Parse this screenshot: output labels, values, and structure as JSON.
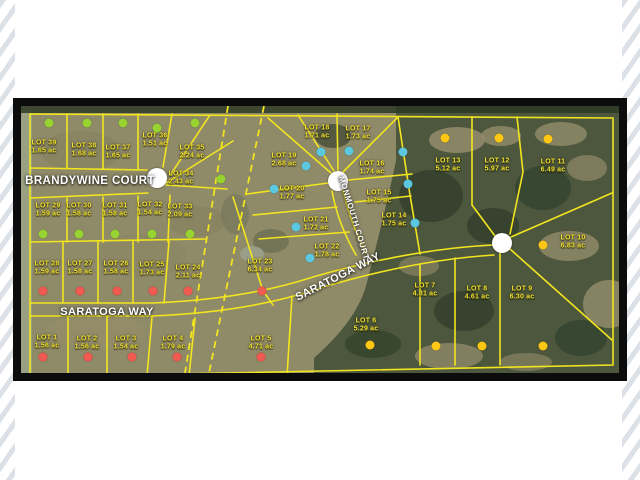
{
  "map": {
    "title": "aerial plat map of subdivision lots",
    "roads": [
      {
        "id": "brandywine-court",
        "label": "BRANDYWINE COURT"
      },
      {
        "id": "saratoga-way-west",
        "label": "SARATOGA WAY"
      },
      {
        "id": "saratoga-way-curve",
        "label": "SARATOGA WAY"
      },
      {
        "id": "monmouth-court",
        "label": "MONMOUTH COURT"
      }
    ],
    "status_colors": {
      "green": "#97d431",
      "red": "#f05a50",
      "cyan": "#5cc8e0",
      "yellow": "#ffc613"
    },
    "cul_de_sacs": [
      {
        "id": "brandywine-circle",
        "x": 136,
        "y": 72
      },
      {
        "id": "monmouth-circle",
        "x": 317,
        "y": 75
      },
      {
        "id": "east-circle",
        "x": 481,
        "y": 137
      }
    ],
    "lots": [
      {
        "name": "LOT 1",
        "area": "1.56 ac",
        "color": "red",
        "lx": 26,
        "ly": 236,
        "dx": 22,
        "dy": 251
      },
      {
        "name": "LOT 2",
        "area": "1.56 ac",
        "color": "red",
        "lx": 66,
        "ly": 237,
        "dx": 67,
        "dy": 251
      },
      {
        "name": "LOT 3",
        "area": "1.54 ac",
        "color": "red",
        "lx": 105,
        "ly": 237,
        "dx": 111,
        "dy": 251
      },
      {
        "name": "LOT 4",
        "area": "1.79 ac",
        "color": "red",
        "lx": 152,
        "ly": 237,
        "dx": 156,
        "dy": 251
      },
      {
        "name": "LOT 5",
        "area": "4.71 ac",
        "color": "red",
        "lx": 240,
        "ly": 237,
        "dx": 240,
        "dy": 251
      },
      {
        "name": "LOT 6",
        "area": "5.29 ac",
        "color": "yellow",
        "lx": 345,
        "ly": 219,
        "dx": 349,
        "dy": 239
      },
      {
        "name": "LOT 7",
        "area": "4.81 ac",
        "color": "yellow",
        "lx": 404,
        "ly": 184,
        "dx": 415,
        "dy": 240
      },
      {
        "name": "LOT 8",
        "area": "4.61 ac",
        "color": "yellow",
        "lx": 456,
        "ly": 187,
        "dx": 461,
        "dy": 240
      },
      {
        "name": "LOT 9",
        "area": "6.30 ac",
        "color": "yellow",
        "lx": 501,
        "ly": 187,
        "dx": 522,
        "dy": 240
      },
      {
        "name": "LOT 10",
        "area": "6.83 ac",
        "color": "yellow",
        "lx": 552,
        "ly": 136,
        "dx": 522,
        "dy": 139
      },
      {
        "name": "LOT 11",
        "area": "6.49 ac",
        "color": "yellow",
        "lx": 532,
        "ly": 60,
        "dx": 527,
        "dy": 33
      },
      {
        "name": "LOT 12",
        "area": "5.97 ac",
        "color": "yellow",
        "lx": 476,
        "ly": 59,
        "dx": 478,
        "dy": 32
      },
      {
        "name": "LOT 13",
        "area": "5.12 ac",
        "color": "yellow",
        "lx": 427,
        "ly": 59,
        "dx": 424,
        "dy": 32
      },
      {
        "name": "LOT 14",
        "area": "1.75 ac",
        "color": "cyan",
        "lx": 373,
        "ly": 114,
        "dx": 394,
        "dy": 117
      },
      {
        "name": "LOT 15",
        "area": "1.75 ac",
        "color": "cyan",
        "lx": 358,
        "ly": 91,
        "dx": 387,
        "dy": 78
      },
      {
        "name": "LOT 16",
        "area": "1.74 ac",
        "color": "cyan",
        "lx": 351,
        "ly": 62,
        "dx": 382,
        "dy": 46
      },
      {
        "name": "LOT 17",
        "area": "1.73 ac",
        "color": "cyan",
        "lx": 337,
        "ly": 27,
        "dx": 328,
        "dy": 45
      },
      {
        "name": "LOT 18",
        "area": "1.71 ac",
        "color": "cyan",
        "lx": 296,
        "ly": 26,
        "dx": 300,
        "dy": 46
      },
      {
        "name": "LOT 19",
        "area": "2.68 ac",
        "color": "cyan",
        "lx": 263,
        "ly": 54,
        "dx": 285,
        "dy": 60
      },
      {
        "name": "LOT 20",
        "area": "1.77 ac",
        "color": "cyan",
        "lx": 271,
        "ly": 87,
        "dx": 253,
        "dy": 83
      },
      {
        "name": "LOT 21",
        "area": "1.72 ac",
        "color": "cyan",
        "lx": 295,
        "ly": 118,
        "dx": 275,
        "dy": 121
      },
      {
        "name": "LOT 22",
        "area": "1.78 ac",
        "color": "cyan",
        "lx": 306,
        "ly": 145,
        "dx": 289,
        "dy": 152
      },
      {
        "name": "LOT 23",
        "area": "6.34 ac",
        "color": "red",
        "lx": 239,
        "ly": 160,
        "dx": 241,
        "dy": 185
      },
      {
        "name": "LOT 24",
        "area": "2.11 ac",
        "color": "red",
        "lx": 167,
        "ly": 166,
        "dx": 167,
        "dy": 185
      },
      {
        "name": "LOT 25",
        "area": "1.73 ac",
        "color": "red",
        "lx": 131,
        "ly": 163,
        "dx": 132,
        "dy": 185
      },
      {
        "name": "LOT 26",
        "area": "1.58 ac",
        "color": "red",
        "lx": 95,
        "ly": 162,
        "dx": 96,
        "dy": 185
      },
      {
        "name": "LOT 27",
        "area": "1.58 ac",
        "color": "red",
        "lx": 59,
        "ly": 162,
        "dx": 59,
        "dy": 185
      },
      {
        "name": "LOT 28",
        "area": "1.59 ac",
        "color": "red",
        "lx": 26,
        "ly": 162,
        "dx": 22,
        "dy": 185
      },
      {
        "name": "LOT 29",
        "area": "1.59 ac",
        "color": "green",
        "lx": 27,
        "ly": 104,
        "dx": 22,
        "dy": 128
      },
      {
        "name": "LOT 30",
        "area": "1.58 ac",
        "color": "green",
        "lx": 58,
        "ly": 104,
        "dx": 58,
        "dy": 128
      },
      {
        "name": "LOT 31",
        "area": "1.58 ac",
        "color": "green",
        "lx": 94,
        "ly": 104,
        "dx": 94,
        "dy": 128
      },
      {
        "name": "LOT 32",
        "area": "1.54 ac",
        "color": "green",
        "lx": 129,
        "ly": 103,
        "dx": 131,
        "dy": 128
      },
      {
        "name": "LOT 33",
        "area": "2.09 ac",
        "color": "green",
        "lx": 159,
        "ly": 105,
        "dx": 169,
        "dy": 128
      },
      {
        "name": "LOT 34",
        "area": "2.43 ac",
        "color": "green",
        "lx": 160,
        "ly": 72,
        "dx": 200,
        "dy": 73
      },
      {
        "name": "LOT 35",
        "area": "2.24 ac",
        "color": "green",
        "lx": 171,
        "ly": 46,
        "dx": 174,
        "dy": 17
      },
      {
        "name": "LOT 36",
        "area": "1.51 ac",
        "color": "green",
        "lx": 134,
        "ly": 34,
        "dx": 136,
        "dy": 22
      },
      {
        "name": "LOT 37",
        "area": "1.65 ac",
        "color": "green",
        "lx": 97,
        "ly": 46,
        "dx": 102,
        "dy": 17
      },
      {
        "name": "LOT 38",
        "area": "1.68 ac",
        "color": "green",
        "lx": 63,
        "ly": 44,
        "dx": 66,
        "dy": 17
      },
      {
        "name": "LOT 39",
        "area": "1.65 ac",
        "color": "green",
        "lx": 23,
        "ly": 41,
        "dx": 28,
        "dy": 17
      }
    ]
  }
}
